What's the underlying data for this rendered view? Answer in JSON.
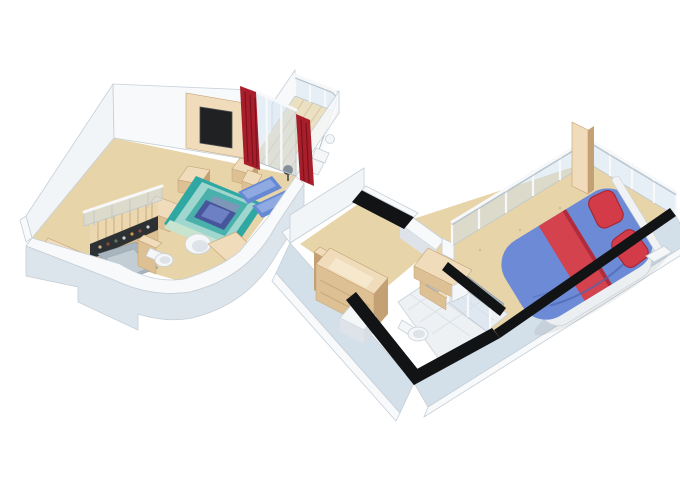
{
  "illustration": {
    "kind": "isometric-3d-floor-plan",
    "subject": "two-level loft cabin suite shown as a pair of cutaway 3D floor plans",
    "units": [
      {
        "id": "lower-level",
        "rooms": [
          "living-room",
          "stair-hall",
          "bathroom",
          "balcony"
        ],
        "furniture": [
          "staircase",
          "stair-railing",
          "under-stair-minibar",
          "sideboard",
          "tv-wall-panel",
          "television",
          "media-bench",
          "media-cabinet",
          "area-rug",
          "loveseat",
          "chaise-lounge-1",
          "chaise-lounge-2",
          "desk",
          "egg-chair",
          "toilet",
          "shower",
          "vanity-partition",
          "red-curtain-1",
          "red-curtain-2",
          "balcony-chair",
          "balcony-table",
          "balcony-fan"
        ]
      },
      {
        "id": "upper-level",
        "rooms": [
          "entry-corridor",
          "wardrobe-closet",
          "bathroom",
          "bedroom",
          "gallery-railing"
        ],
        "furniture": [
          "wardrobe",
          "closet-partition",
          "drawer-cube",
          "vanity-desk",
          "washbasin-cabinet",
          "toilet",
          "shower-enclosure",
          "double-bed",
          "bed-runner-stripe",
          "pillow-1",
          "pillow-2",
          "bedside-shelf",
          "wood-screen-panel",
          "glass-railing"
        ]
      }
    ]
  },
  "palette": {
    "page_bg": "#ffffff",
    "wall_white": "#f7f9fb",
    "wall_inner": "#f2f5f8",
    "wall_face": "#dde5ec",
    "wall_face_blue": "#d3dfe9",
    "wall_stroke": "#c6cfd7",
    "wall_black": "#121315",
    "floor_tan": "#e8d4a9",
    "floor_tan_light": "#eddcb8",
    "deck": "#ece0c3",
    "deck_line": "#d6c5a0",
    "wood_top": "#f0dcba",
    "wood_face": "#ddc093",
    "wood_dark": "#c3a174",
    "glass": "#cfe0ee",
    "rail_white": "#f6f8fa",
    "tile": "#eef1f4",
    "tile_line": "#d8dfe4",
    "shower_gray": "#a9b5be",
    "object_white": "#f4f6f8",
    "object_white_shade": "#dde3e8",
    "curtain_red": "#a81f2b",
    "curtain_dark": "#7c121d",
    "tv_black": "#1f2123",
    "rug_teal": "#2fa7a3",
    "rug_aqua": "#9fd6ce",
    "rug_inner": "#4ab0ab",
    "rug_green": "#c8e4cf",
    "rug_center": "#7e97b8",
    "sofa_navy": "#47559b",
    "sofa_navy_light": "#6e80c4",
    "lounge_blue": "#6789d4",
    "lounge_blue_light": "#8fa9e2",
    "bed_blue": "#6d8ad6",
    "bed_blue_dark": "#4a66b4",
    "bed_stripe": "#d4424e",
    "bed_stripe_dark": "#b02c3c",
    "pillow_red": "#d23b47",
    "stair_wood": "#ecd8b0",
    "under_stair": "#2e3134",
    "speckle": "#c9b184"
  }
}
